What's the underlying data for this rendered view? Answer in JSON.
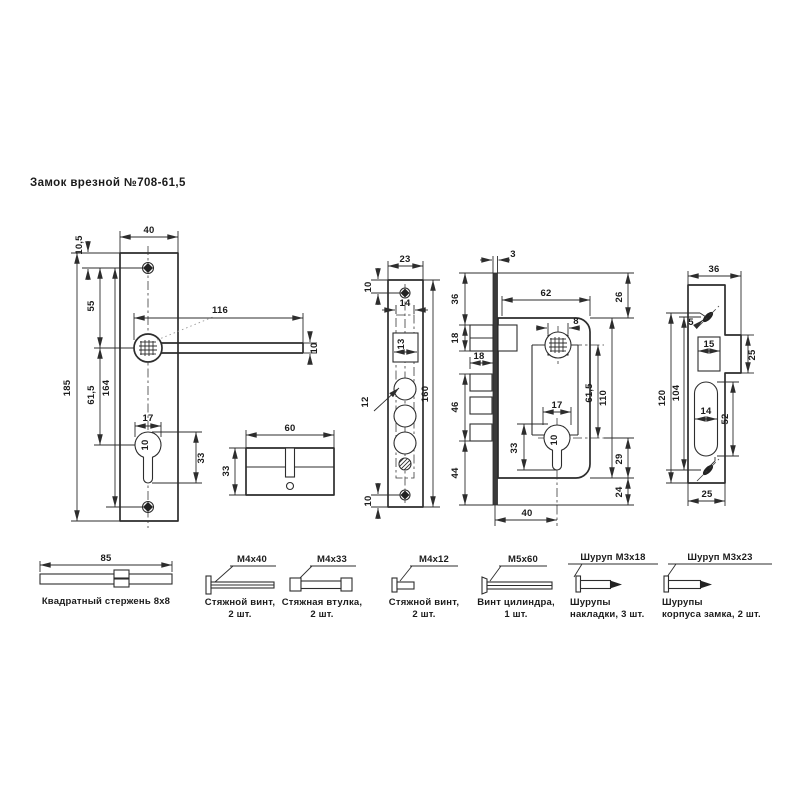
{
  "title": "Замок врезной №708-61,5",
  "views": {
    "handle_plate": {
      "width": "40",
      "top_offset": "10,5",
      "height": "185",
      "hole_spacing": "164",
      "hole_to_handle": "55",
      "handle_to_cyl": "61,5",
      "handle_length": "116",
      "handle_width": "10",
      "cyl_width": "17",
      "cyl_slot_height": "33",
      "cyl_hole_dia": "10"
    },
    "cylinder": {
      "length": "60",
      "height": "33"
    },
    "faceplate": {
      "width": "23",
      "top_hole_offset": "10",
      "bottom_hole_offset": "10",
      "inner_width": "14",
      "latch_size": "13",
      "bolt_dia": "12",
      "height": "160"
    },
    "side_profile": {
      "thickness": "3",
      "top_margin": "36",
      "latch_height": "18",
      "latch_depth": "18",
      "bolt_height": "46",
      "bottom_margin": "44"
    },
    "lock_body": {
      "depth": "62",
      "top_margin": "26",
      "spindle_size": "8",
      "spindle_to_cyl": "61,5",
      "height": "110",
      "cyl_width": "17",
      "cyl_slot_height": "33",
      "cyl_hole_dia": "10",
      "cyl_to_bottom": "29",
      "bottom_margin": "24",
      "backset": "40"
    },
    "strike_plate": {
      "width": "36",
      "hole_dia": "5",
      "latch_hole": "15",
      "tab_height": "25",
      "height": "120",
      "hole_spacing": "104",
      "slot_width": "14",
      "slot_height": "52",
      "bottom_width": "25"
    }
  },
  "parts": [
    {
      "dim": "85",
      "label": "",
      "caption1": "Квадратный стержень 8х8",
      "caption2": ""
    },
    {
      "dim": "",
      "label": "М4х40",
      "caption1": "Стяжной винт,",
      "caption2": "2 шт."
    },
    {
      "dim": "",
      "label": "М4х33",
      "caption1": "Стяжная втулка,",
      "caption2": "2 шт."
    },
    {
      "dim": "",
      "label": "М4х12",
      "caption1": "Стяжной винт,",
      "caption2": "2 шт."
    },
    {
      "dim": "",
      "label": "М5х60",
      "caption1": "Винт цилиндра,",
      "caption2": "1 шт."
    },
    {
      "dim": "",
      "label": "Шуруп М3х18",
      "caption1": "Шурупы",
      "caption2": "накладки, 3 шт."
    },
    {
      "dim": "",
      "label": "Шуруп М3х23",
      "caption1": "Шурупы",
      "caption2": "корпуса замка, 2 шт."
    }
  ]
}
